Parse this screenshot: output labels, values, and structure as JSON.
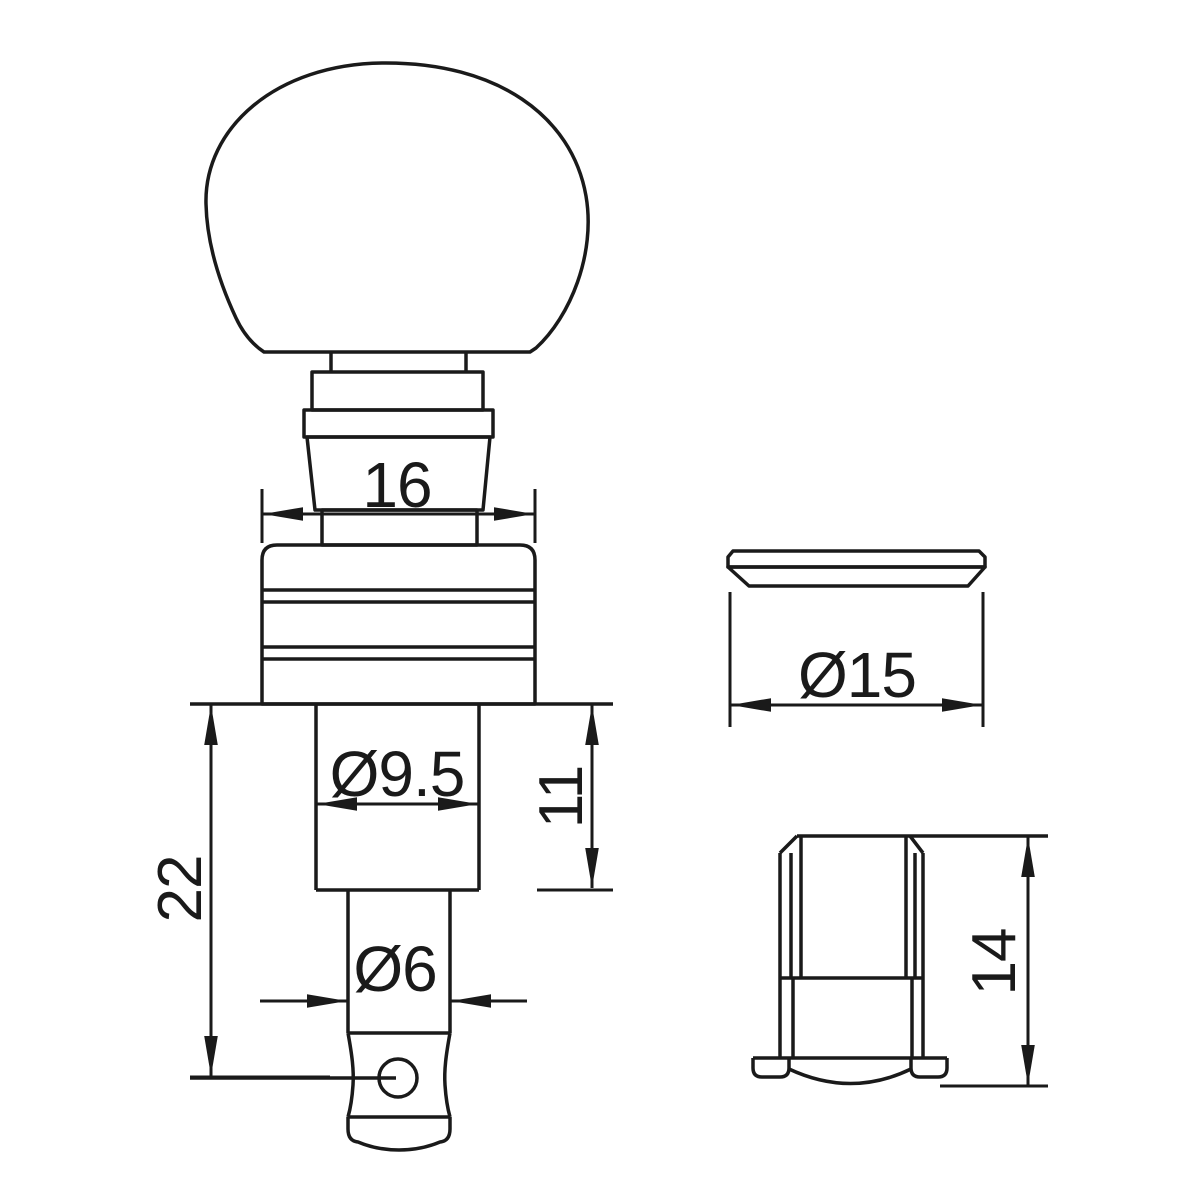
{
  "drawing": {
    "ink_color": "#1a1a1a",
    "paper_color": "#ffffff",
    "dimensions": {
      "collar_width": "16",
      "upper_post_diameter": "Ø9.5",
      "upper_post_length": "11",
      "total_post_length": "22",
      "lower_post_diameter": "Ø6",
      "washer_diameter": "Ø15",
      "bushing_height": "14"
    }
  }
}
